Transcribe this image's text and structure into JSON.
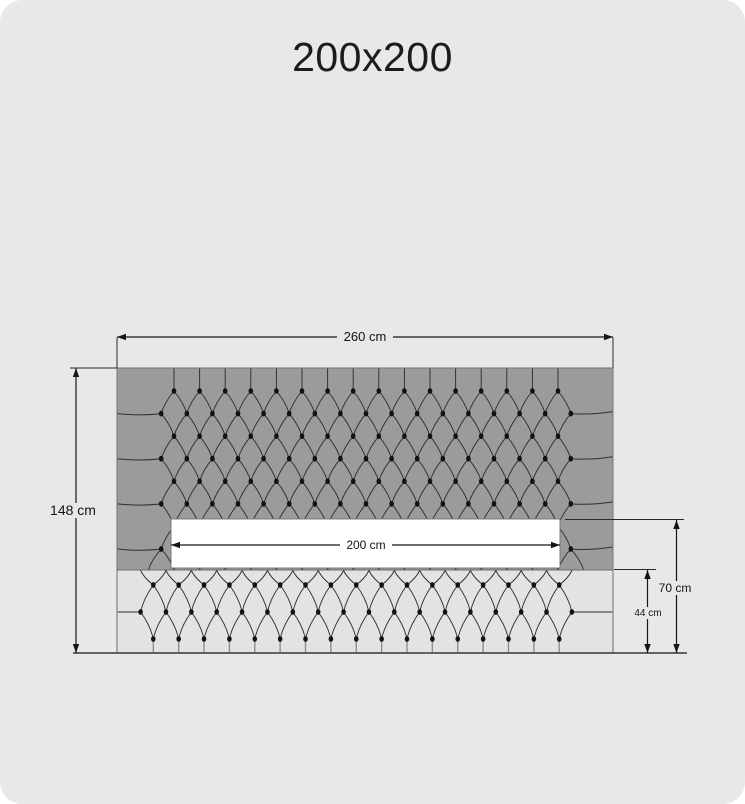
{
  "title": "200x200",
  "dimensions": {
    "total_width": "260 cm",
    "total_height": "148 cm",
    "mattress_width": "200 cm",
    "foot_end_height": "70 cm",
    "base_height": "44 cm"
  },
  "colors": {
    "page_background": "#e8e8e7",
    "headboard_gray": "#9b9b9b",
    "base_gray": "#e3e3e2",
    "mattress_white": "#ffffff",
    "line_ink": "#161616",
    "pattern_line": "#2f2f2f",
    "button_black": "#121212"
  }
}
